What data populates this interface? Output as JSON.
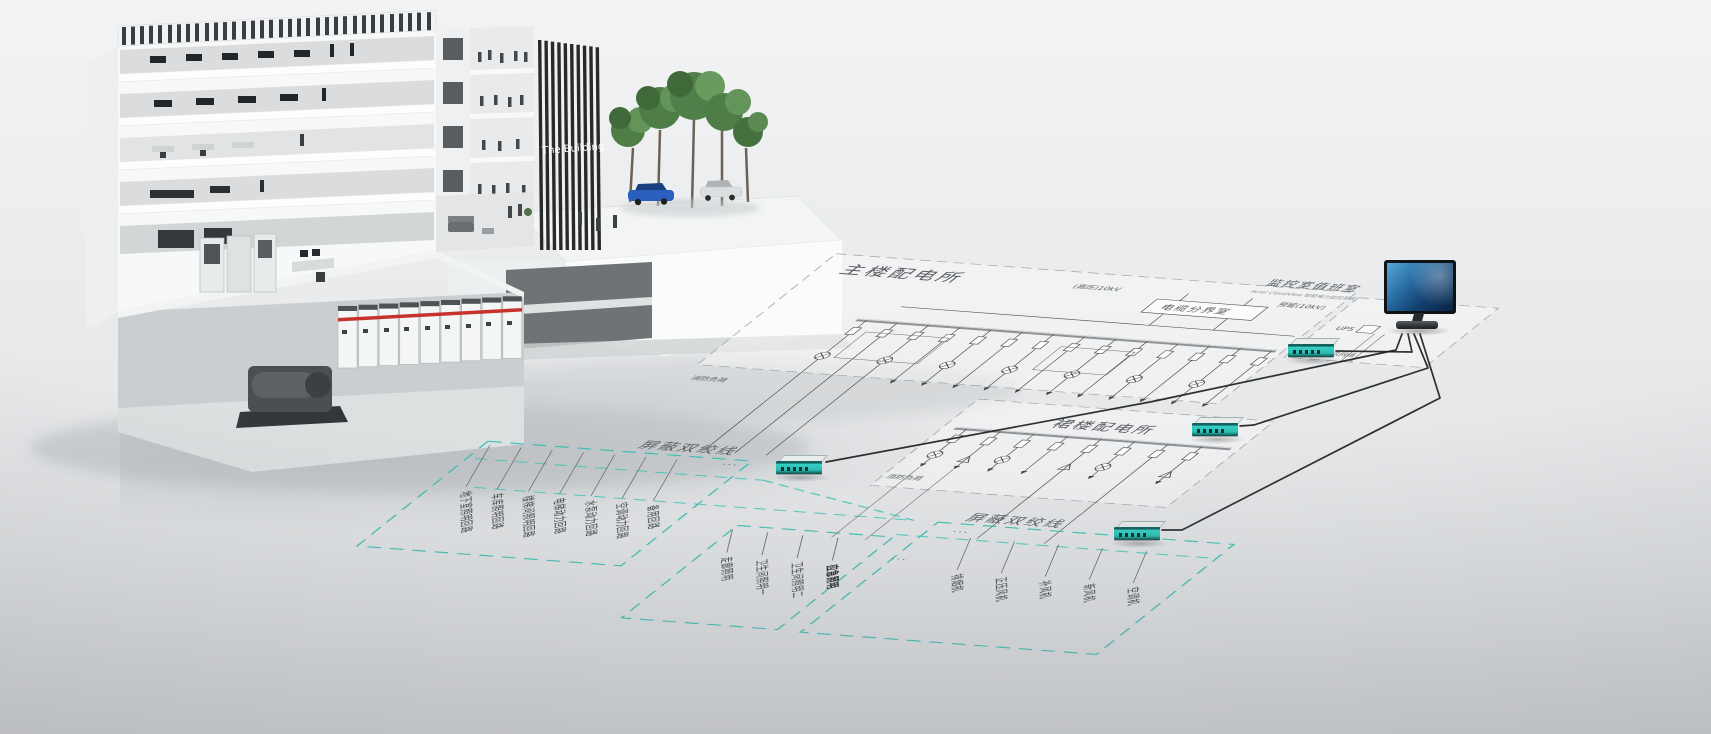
{
  "building": {
    "sign": "The Building"
  },
  "regions": {
    "main": {
      "title": "主楼配电所",
      "cable_room": "电缆分界室",
      "hv": "(高压)10kV",
      "reserve": "预留(10kV)",
      "fire": "消防负荷"
    },
    "podium": {
      "title": "裙楼配电所",
      "fire": "消防负荷"
    },
    "monitor": {
      "title": "监控室值班室",
      "subtitle": "Acrel CloudView 智能电力监控系统",
      "ups": "UPS",
      "network": "TCP/IP通讯网络"
    }
  },
  "zones": {
    "stp1": {
      "title": "屏蔽双绞线"
    },
    "stp2": {
      "title": "屏蔽双绞线"
    },
    "groupA": {
      "labels": [
        "地下室照明回路",
        "车库照明回路",
        "楼梯间照明回路",
        "电梯动力回路",
        "水泵动力回路",
        "空调动力回路",
        "备用回路"
      ]
    },
    "groupB": {
      "labels": [
        "走廊照明",
        "卫生间照明一",
        "卫生间照明二",
        "应急照明"
      ]
    },
    "groupC": {
      "labels": [
        "排烟机",
        "正压风机",
        "补风机",
        "新风机",
        "空调机"
      ]
    }
  },
  "misc": {
    "ellipsis": "···"
  },
  "colors": {
    "teal": "#2fbdb3",
    "schematic_line": "#4c4c4c",
    "region_dash": "#a7abad",
    "screen_blue": "#1b5e96",
    "switchgear_red": "#c8322d",
    "background": "#e8e9eb"
  }
}
